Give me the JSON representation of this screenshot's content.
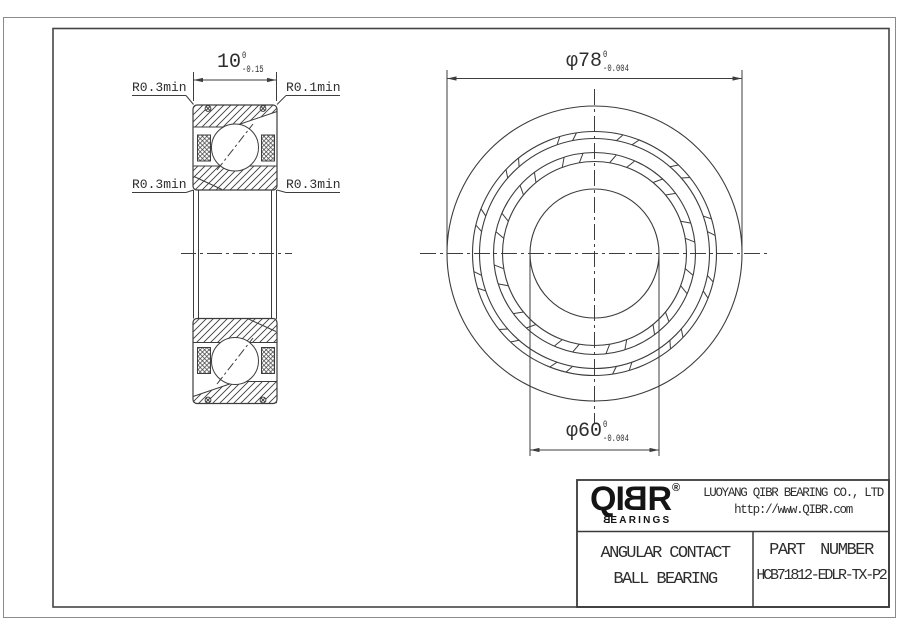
{
  "colors": {
    "line": "#3d3d3d",
    "frame": "#454545",
    "page_border": "#8a8a8a",
    "text": "#2e2e2e",
    "logo": "#141414"
  },
  "section_view": {
    "width_dim": {
      "value": "10",
      "tol_upper": "0",
      "tol_lower": "-0.15"
    },
    "fillet_labels": {
      "top_left": "R0.3min",
      "top_right": "R0.1min",
      "bottom_left": "R0.3min",
      "bottom_right": "R0.3min"
    }
  },
  "front_view": {
    "outer_dia_dim": {
      "value": "φ78",
      "tol_upper": "0",
      "tol_lower": "-0.004"
    },
    "bore_dia_dim": {
      "value": "φ60",
      "tol_upper": "0",
      "tol_lower": "-0.004"
    }
  },
  "title_block": {
    "logo": {
      "text_pre": "QI",
      "text_mirrored": "B",
      "text_post": "R",
      "registered_mark": "®",
      "sub_mirrored": "B",
      "sub_rest": "EARINGS"
    },
    "company_name": "LUOYANG QIBR BEARING CO., LTD",
    "website": "http://www.QIBR.com",
    "product_type_line1": "ANGULAR CONTACT",
    "product_type_line2": "BALL BEARING",
    "part_number_label": "PART NUMBER",
    "part_number": "HCB71812-EDLR-TX-P2"
  }
}
